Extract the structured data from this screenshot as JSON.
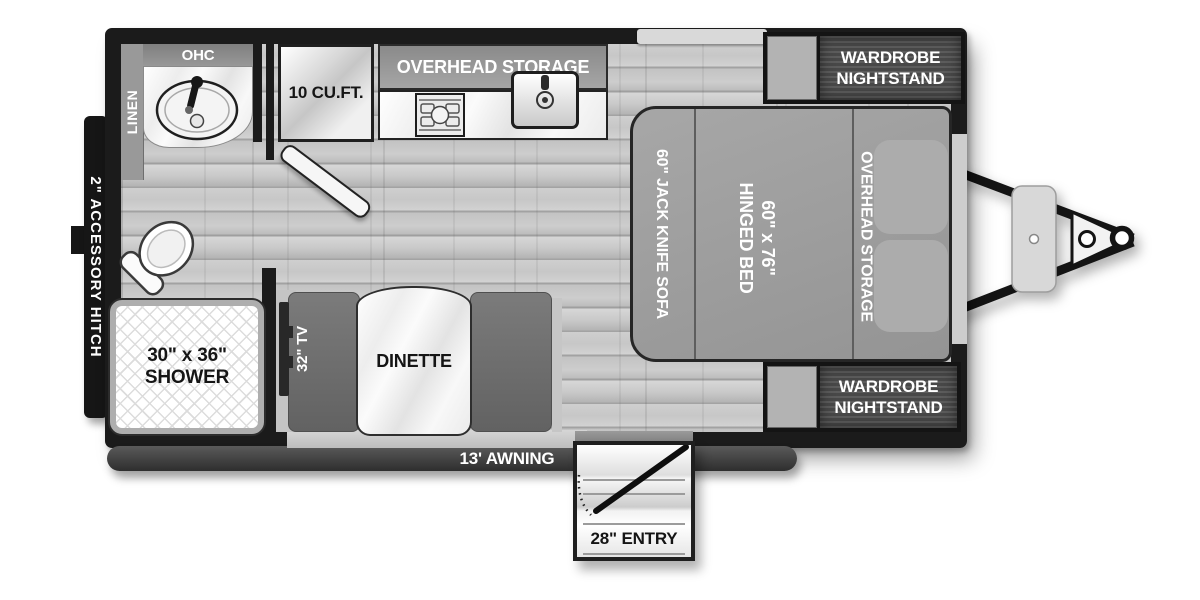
{
  "plan": {
    "bathroom": {
      "linen": "LINEN",
      "overhead_cabinet": "OHC",
      "shower_size": "30\" x 36\"",
      "shower_label": "SHOWER"
    },
    "kitchen": {
      "refrigerator": "10 CU.FT.",
      "overhead_storage": "OVERHEAD STORAGE"
    },
    "bedroom": {
      "sofa": "60\" JACK KNIFE SOFA",
      "bed_size": "60\" x 76\"",
      "bed_type": "HINGED BED",
      "overhead_storage": "OVERHEAD STORAGE",
      "wardrobe_line1": "WARDROBE",
      "wardrobe_line2": "NIGHTSTAND"
    },
    "living": {
      "tv": "32\" TV",
      "dinette": "DINETTE"
    },
    "exterior": {
      "accessory_hitch": "2\" ACCESSORY HITCH",
      "awning": "13' AWNING",
      "entry": "28\" ENTRY"
    }
  },
  "colors": {
    "wall": "#1b1b1b",
    "floor": "#c9c9c9",
    "bed_gray": "#9c9c9c",
    "bench_gray": "#6e6e6e",
    "wardrobe_dark": "#4e4e4e",
    "window_light": "#d9d9d9",
    "label_white": "#ffffff",
    "label_black": "#161616"
  }
}
